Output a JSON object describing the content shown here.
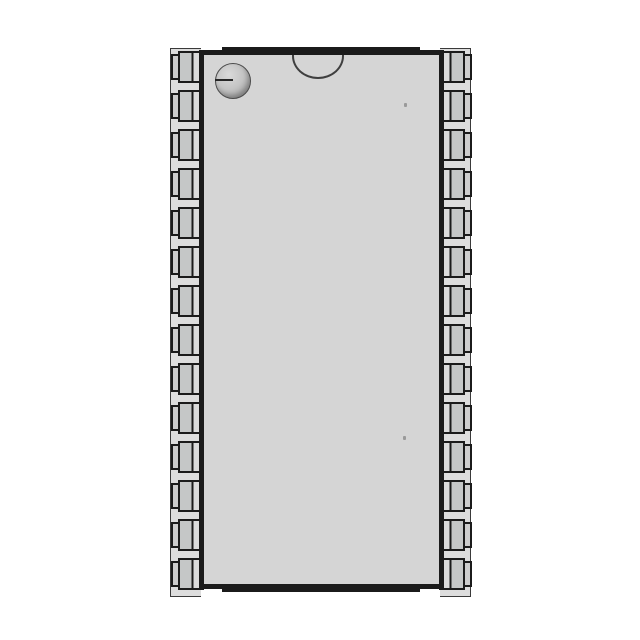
{
  "component": {
    "kind": "integrated-circuit-package",
    "view": "top",
    "package_style": "wide-body surface-mount (SOIC-type)",
    "pins_per_side": 14,
    "total_pins": 28,
    "features": {
      "pin1_indicator": "circular dimple, top-left corner",
      "orientation_notch": "semicircular notch, top-center edge",
      "mold_marks": 2
    }
  },
  "colors": {
    "ink": "#1b1b1b",
    "body": "#d5d5d5",
    "rail": "#dddddd",
    "edge": "#3a3a3a",
    "leadA": "#c5c7c7",
    "leadB": "#dbdbdb",
    "foot": "#cdcdcd",
    "notch-line": "#3f3f3f"
  },
  "geometry": {
    "pin_first_top": 51,
    "pin_pitch": 39,
    "pin_height": 32,
    "pin_row_left_x": 171,
    "pin_row_right_x": 439
  }
}
